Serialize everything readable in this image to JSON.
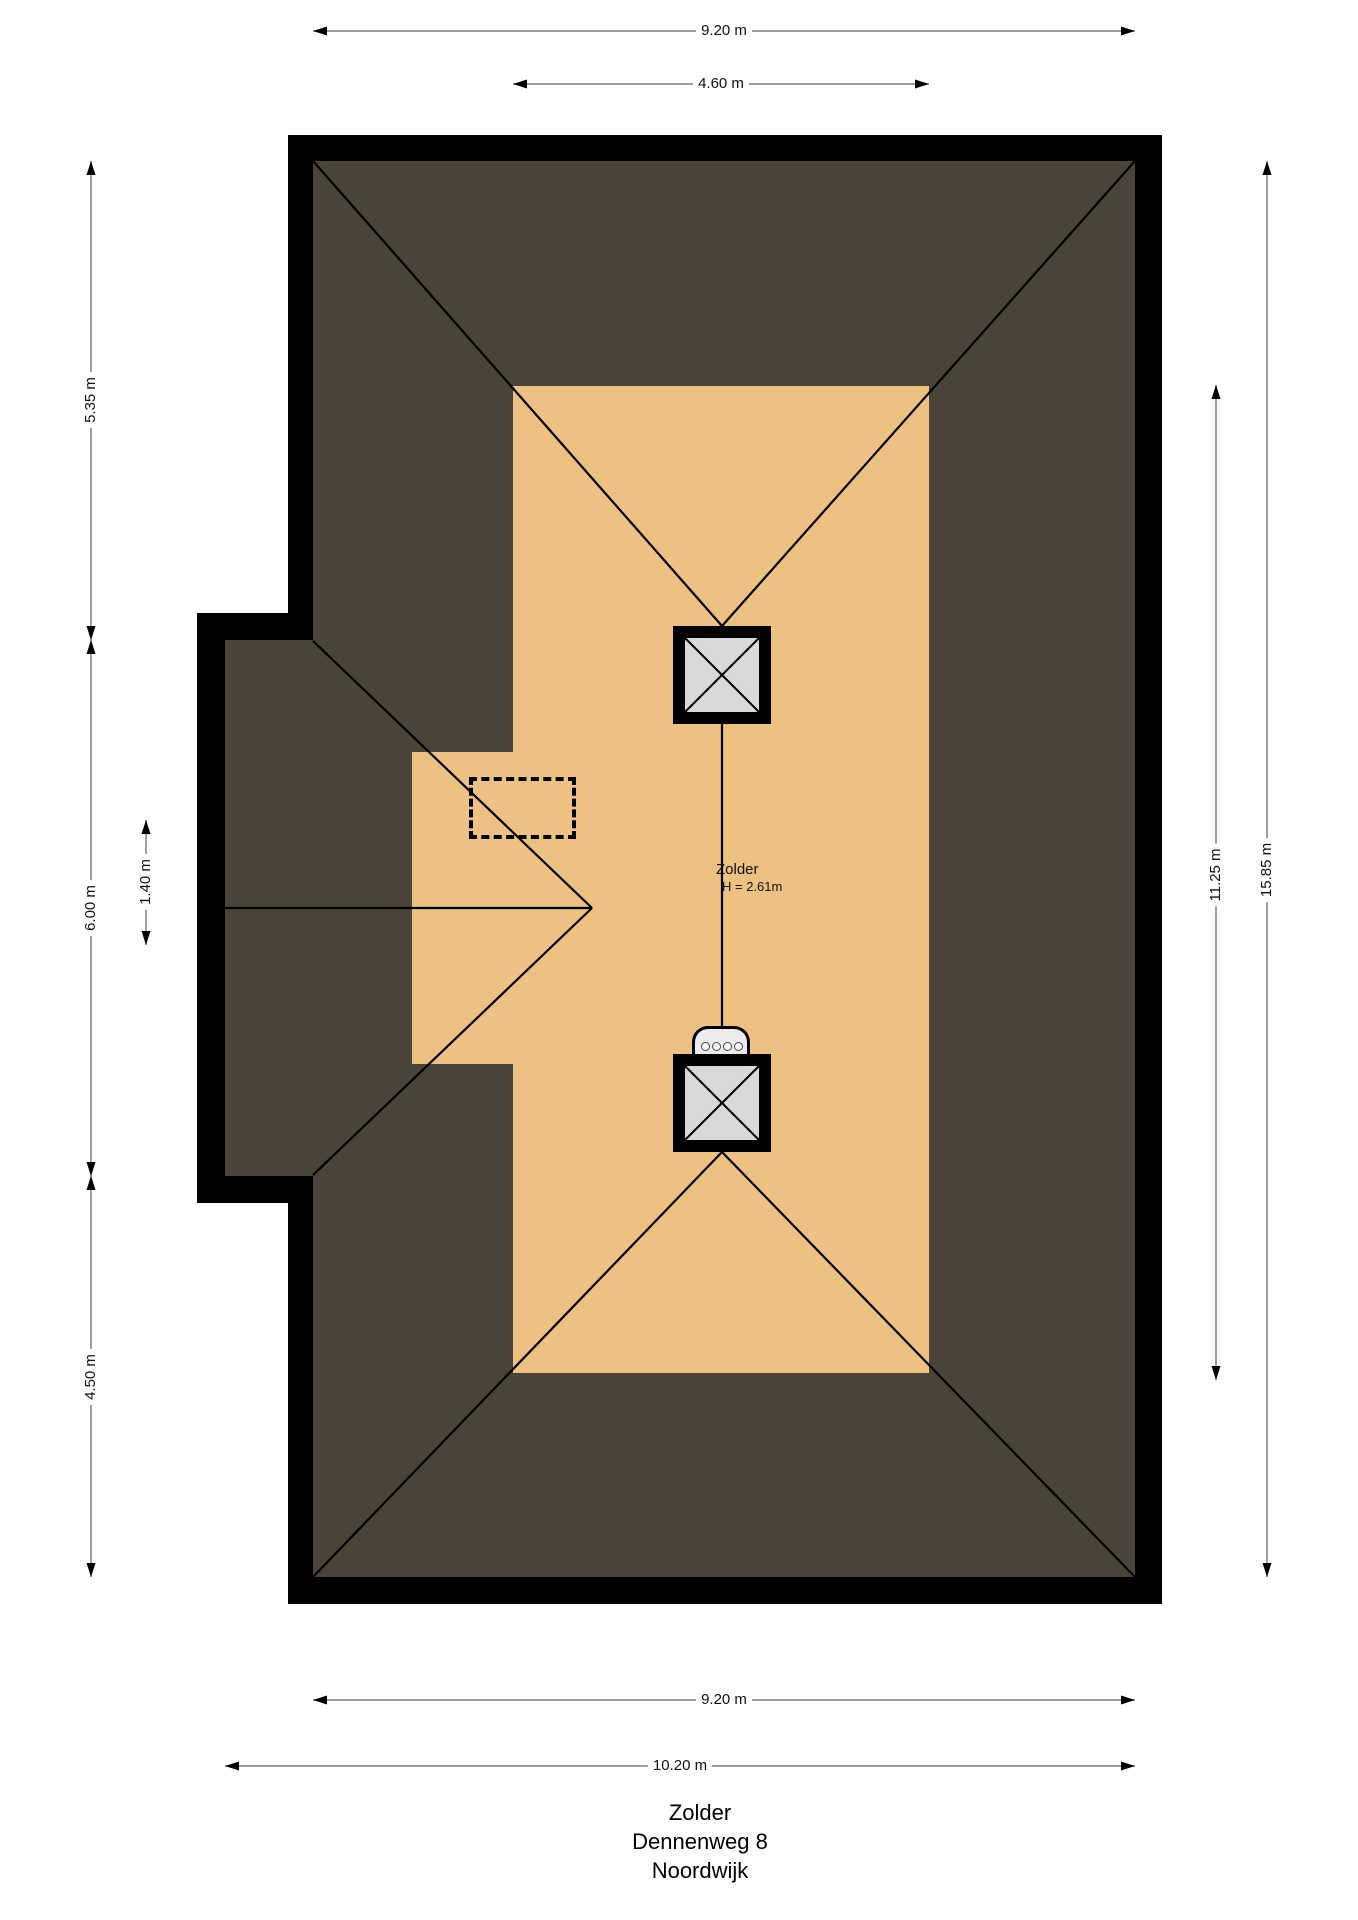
{
  "floorplan": {
    "room_label": {
      "name": "Zolder",
      "ceiling_height": "H = 2.61m"
    },
    "dimensions": {
      "top_outer": "9.20 m",
      "top_attic": "4.60 m",
      "left_top": "5.35 m",
      "left_middle": "6.00 m",
      "left_inner": "1.40 m",
      "left_bottom": "4.50 m",
      "right_inner": "11.25 m",
      "right_outer": "15.85 m",
      "bottom_inner": "9.20 m",
      "bottom_outer": "10.20 m"
    },
    "title": {
      "line1": "Zolder",
      "line2": "Dennenweg 8",
      "line3": "Noordwijk"
    },
    "colors": {
      "roof_area": "#4a4337",
      "attic_floor": "#ecc182",
      "walls": "#000000",
      "skylight_pane": "#d9d9d9",
      "dimension_line": "#7f7f7f",
      "background": "#ffffff"
    }
  }
}
